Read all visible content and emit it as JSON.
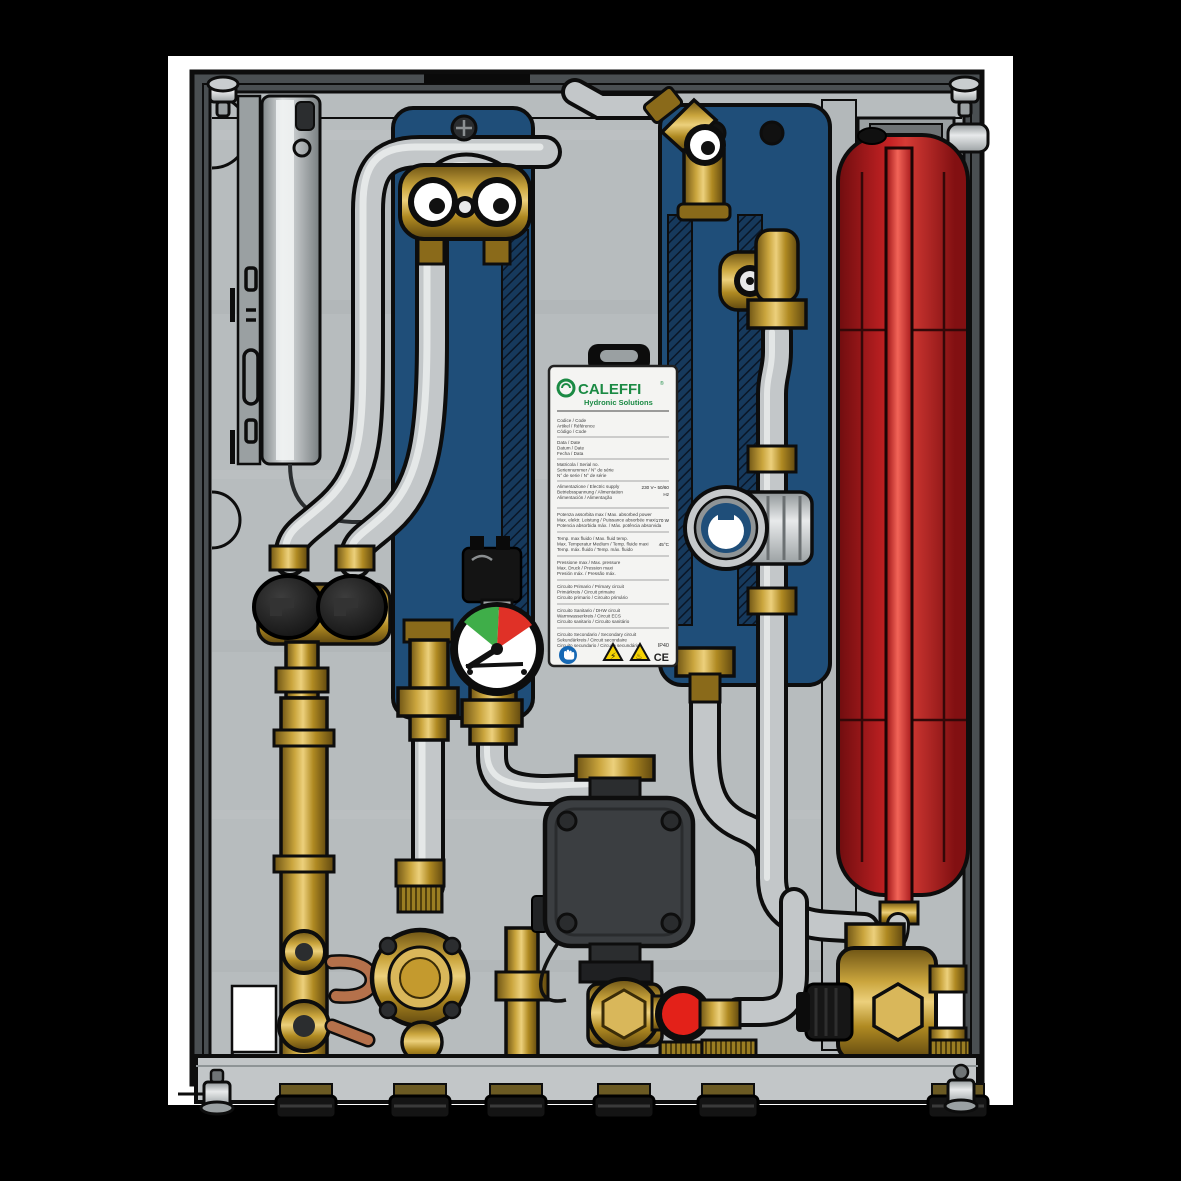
{
  "product": {
    "brand": "CALEFFI",
    "brand_mark": "®",
    "tagline": "Hydronic Solutions"
  },
  "label": {
    "blocks": [
      {
        "lines": [
          "Codice / Code",
          "Artikel / Référence",
          "Código / Code"
        ],
        "values": []
      },
      {
        "lines": [
          "Data / Date",
          "Datum / Date",
          "Fecha / Data"
        ],
        "values": []
      },
      {
        "lines": [
          "Matricola / Serial no.",
          "Seriennummer / N° de série",
          "N° de serie / N° de série"
        ],
        "values": []
      },
      {
        "lines": [
          "Alimentazione / Electric supply",
          "Betriebsspannung / Alimentation",
          "Alimentación / Alimentação"
        ],
        "values": [
          "230 V~ 50/60",
          "Hz"
        ]
      },
      {
        "lines": [
          "Potenza assorbita max / Max. absorbed power",
          "Max. elektr. Leistung / Puissance absorbée maxi",
          "Potencia absorbida máx. / Máx. potência absorvida"
        ],
        "values": [
          "170 W"
        ]
      },
      {
        "lines": [
          "Temp. max fluido / Max. fluid temp.",
          "Max. Temperatur Medium / Temp. fluide maxi",
          "Temp. máx. fluido / Temp. máx. fluido"
        ],
        "values": [
          "45°C"
        ]
      },
      {
        "lines": [
          "Pressione max / Max. pressure",
          "Max. Druck / Pression maxi",
          "Presión máx. / Pressão máx."
        ],
        "values": []
      },
      {
        "lines": [
          "Circuito Primario / Primary circuit",
          "Primärkreis / Circuit primaire",
          "Circuito primario / Circuito primário"
        ],
        "values": []
      },
      {
        "lines": [
          "Circuito Sanitario / DHW circuit",
          "Warmwasserkreis / Circuit ECS",
          "Circuito sanitario / Circuito sanitário"
        ],
        "values": []
      },
      {
        "lines": [
          "Circuito Secondario / Secondary circuit",
          "Sekundärkreis / Circuit secondaire",
          "Circuito secundario / Circuito secundário"
        ],
        "values": []
      }
    ],
    "ip_rating": "IP40",
    "ce_mark": "CE",
    "icons": [
      {
        "name": "protective-gloves-mandatory",
        "glyph": "✋",
        "color": "#1668b4"
      },
      {
        "name": "electric-hazard-warning",
        "glyph": "⚡",
        "color": "#f6d303"
      },
      {
        "name": "hot-surface-warning",
        "glyph": "♨",
        "color": "#f6d303"
      }
    ]
  },
  "colors": {
    "canvas": "#000000",
    "backdrop": "#ffffff",
    "frame": "#4a4f52",
    "panel": "#b7bcbe",
    "hx_blue": "#1f4e79",
    "vessel_red": "#a6191b",
    "pipe_gray": "#c3c7c9",
    "brass": "#caa53d",
    "copper": "#b5714b",
    "gauge_green": "#3fae49",
    "gauge_red": "#e03127",
    "knob_red": "#e32119",
    "label_green": "#1b8a44",
    "pump_dark": "#3b3e41"
  },
  "gauge": {
    "type": "temperature-dial",
    "zones": [
      "green",
      "red"
    ]
  }
}
